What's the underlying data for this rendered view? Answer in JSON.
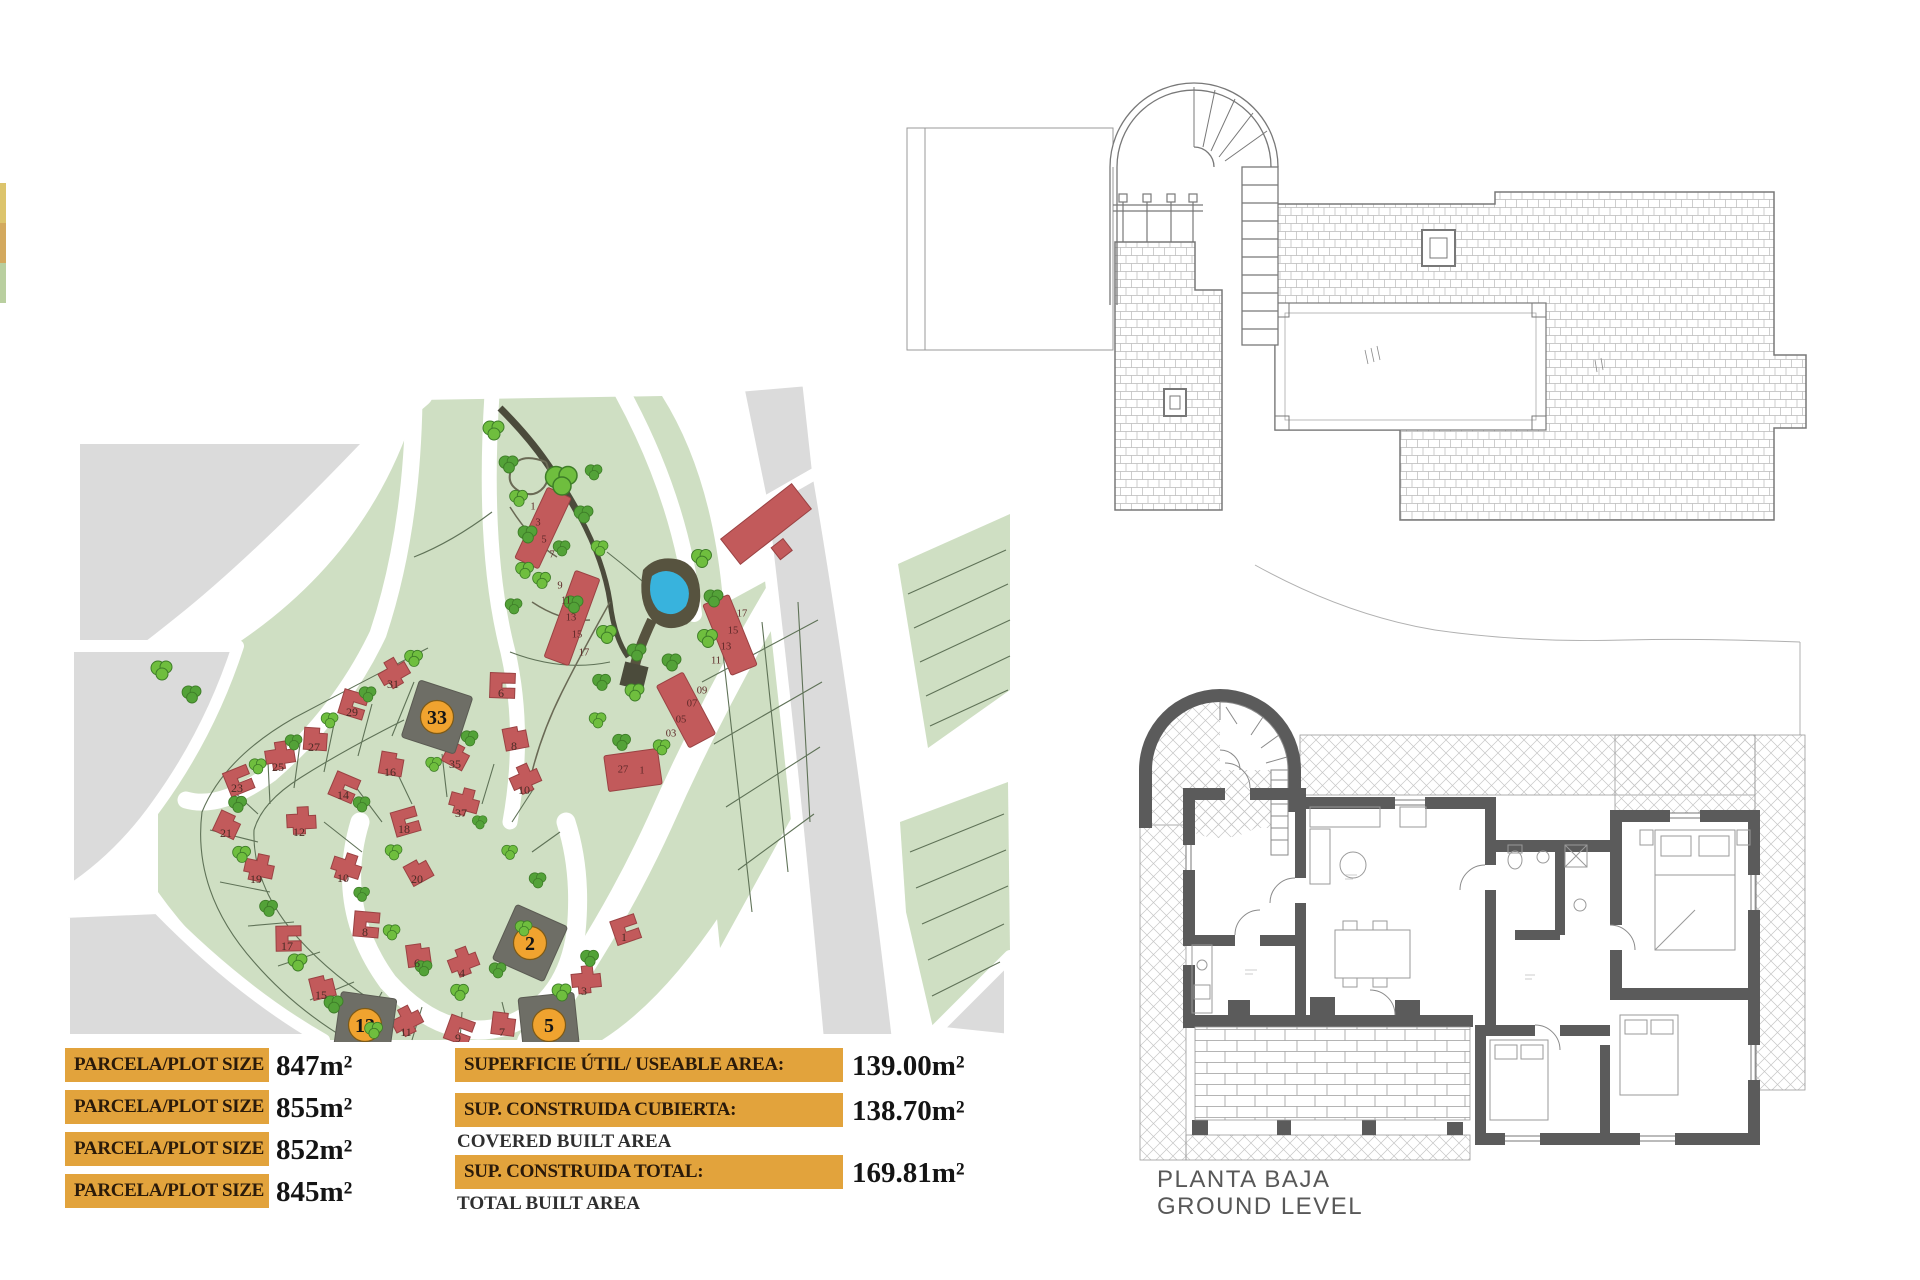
{
  "palette": {
    "orange": "#E2A33C",
    "barText": "#2A1A0A",
    "valueText": "#141414",
    "mapGreen": "#CFDFC3",
    "mapLine": "#5F7257",
    "mapGray": "#DBDBDB",
    "houseRed": "#C25A5B",
    "houseEdge": "#9A4243",
    "treeGreen": "#6FBE3E",
    "treeDark": "#53A238",
    "treeEdge": "#3E7D28",
    "poolBlue": "#38B3DD",
    "poolDark": "#57533F",
    "pathDark": "#4B4B3B",
    "plotDark": "#6E6E66",
    "markerOrange": "#F0A32F",
    "wallGray": "#5B5B5B",
    "planLine": "#8A8A8A",
    "hatchLine": "#B9B9B9",
    "labelGray": "#585858",
    "numberRed": "#4A2B25"
  },
  "info_panel": {
    "left_rows": [
      {
        "label": "PARCELA/PLOT SIZE 33:",
        "value": "847m²"
      },
      {
        "label": "PARCELA/PLOT SIZE 2:",
        "value": "855m²"
      },
      {
        "label": "PARCELA/PLOT SIZE 13:",
        "value": "852m²"
      },
      {
        "label": "PARCELA/PLOT SIZE 5:",
        "value": "845m²"
      }
    ],
    "right_rows": [
      {
        "label": "SUPERFICIE ÚTIL/ USEABLE AREA:",
        "value": "139.00m²",
        "sublabel": ""
      },
      {
        "label": "SUP. CONSTRUIDA CUBIERTA:",
        "value": "138.70m²",
        "sublabel": "COVERED BUILT AREA"
      },
      {
        "label": "SUP. CONSTRUIDA TOTAL:",
        "value": "169.81m²",
        "sublabel": "TOTAL BUILT AREA"
      }
    ]
  },
  "floor_plan": {
    "title_line1": "PLANTA BAJA",
    "title_line2": "GROUND LEVEL"
  },
  "site_plan": {
    "highlighted_plots": [
      {
        "number": "33",
        "x": 375,
        "y": 365,
        "rot": 18
      },
      {
        "number": "2",
        "x": 468,
        "y": 591,
        "rot": 24
      },
      {
        "number": "13",
        "x": 303,
        "y": 673,
        "rot": 8
      },
      {
        "number": "5",
        "x": 487,
        "y": 673,
        "rot": -6
      }
    ],
    "plot_numbers": [
      {
        "n": "31",
        "x": 331,
        "y": 332
      },
      {
        "n": "29",
        "x": 290,
        "y": 360
      },
      {
        "n": "27",
        "x": 252,
        "y": 395
      },
      {
        "n": "25",
        "x": 216,
        "y": 415
      },
      {
        "n": "23",
        "x": 175,
        "y": 436
      },
      {
        "n": "21",
        "x": 164,
        "y": 481
      },
      {
        "n": "19",
        "x": 194,
        "y": 527
      },
      {
        "n": "17",
        "x": 225,
        "y": 594
      },
      {
        "n": "15",
        "x": 259,
        "y": 643
      },
      {
        "n": "11",
        "x": 344,
        "y": 680
      },
      {
        "n": "9",
        "x": 396,
        "y": 686
      },
      {
        "n": "7",
        "x": 440,
        "y": 680
      },
      {
        "n": "3",
        "x": 522,
        "y": 639
      },
      {
        "n": "1",
        "x": 562,
        "y": 585
      },
      {
        "n": "35",
        "x": 393,
        "y": 412
      },
      {
        "n": "37",
        "x": 399,
        "y": 461
      },
      {
        "n": "6",
        "x": 439,
        "y": 341
      },
      {
        "n": "8",
        "x": 452,
        "y": 394
      },
      {
        "n": "10",
        "x": 462,
        "y": 438
      },
      {
        "n": "14",
        "x": 281,
        "y": 443
      },
      {
        "n": "16",
        "x": 328,
        "y": 420
      },
      {
        "n": "12",
        "x": 237,
        "y": 480
      },
      {
        "n": "18",
        "x": 342,
        "y": 477
      },
      {
        "n": "20",
        "x": 355,
        "y": 527
      },
      {
        "n": "10",
        "x": 281,
        "y": 526
      },
      {
        "n": "8",
        "x": 303,
        "y": 580
      },
      {
        "n": "6",
        "x": 355,
        "y": 611
      },
      {
        "n": "4",
        "x": 400,
        "y": 621
      }
    ],
    "terrace_units": [
      {
        "n": "1",
        "x": 471,
        "y": 154
      },
      {
        "n": "3",
        "x": 476,
        "y": 170
      },
      {
        "n": "5",
        "x": 482,
        "y": 187
      },
      {
        "n": "7",
        "x": 490,
        "y": 202
      },
      {
        "n": "9",
        "x": 498,
        "y": 233
      },
      {
        "n": "11",
        "x": 504,
        "y": 248
      },
      {
        "n": "13",
        "x": 509,
        "y": 265
      },
      {
        "n": "15",
        "x": 515,
        "y": 282
      },
      {
        "n": "17",
        "x": 522,
        "y": 300
      },
      {
        "n": "17",
        "x": 680,
        "y": 261
      },
      {
        "n": "15",
        "x": 671,
        "y": 278
      },
      {
        "n": "13",
        "x": 664,
        "y": 294
      },
      {
        "n": "11",
        "x": 654,
        "y": 308
      },
      {
        "n": "09",
        "x": 640,
        "y": 338
      },
      {
        "n": "07",
        "x": 630,
        "y": 351
      },
      {
        "n": "05",
        "x": 619,
        "y": 367
      },
      {
        "n": "03",
        "x": 609,
        "y": 381
      },
      {
        "n": "27",
        "x": 561,
        "y": 417
      },
      {
        "n": "1",
        "x": 580,
        "y": 418
      }
    ]
  }
}
